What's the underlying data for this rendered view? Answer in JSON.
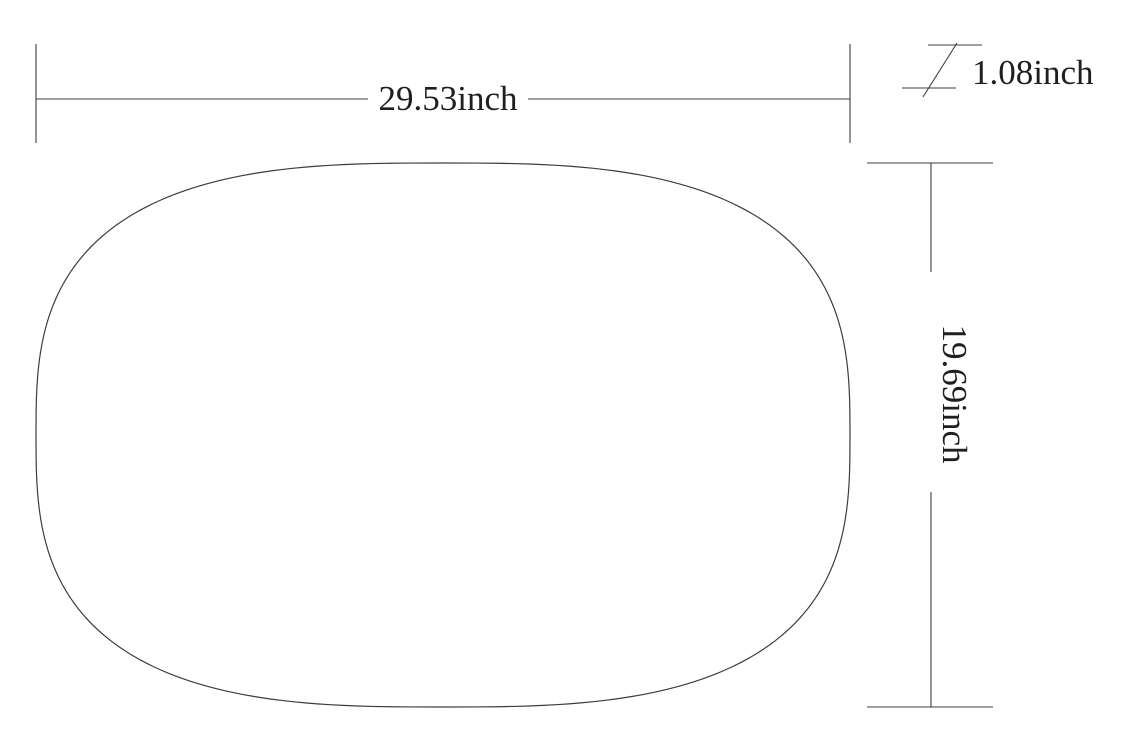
{
  "title": "Oval mat dimension drawing",
  "colors": {
    "background": "#ffffff",
    "line": "#3d3d3d",
    "text": "#1f1f1f"
  },
  "dimensions": {
    "width_label": "29.53inch",
    "height_label": "19.69inch",
    "thickness_label": "1.08inch"
  },
  "shape": {
    "kind": "rounded-oval-outline",
    "cx": 443,
    "cy": 435,
    "rx": 407,
    "ry": 272,
    "exponent": 2.9
  }
}
